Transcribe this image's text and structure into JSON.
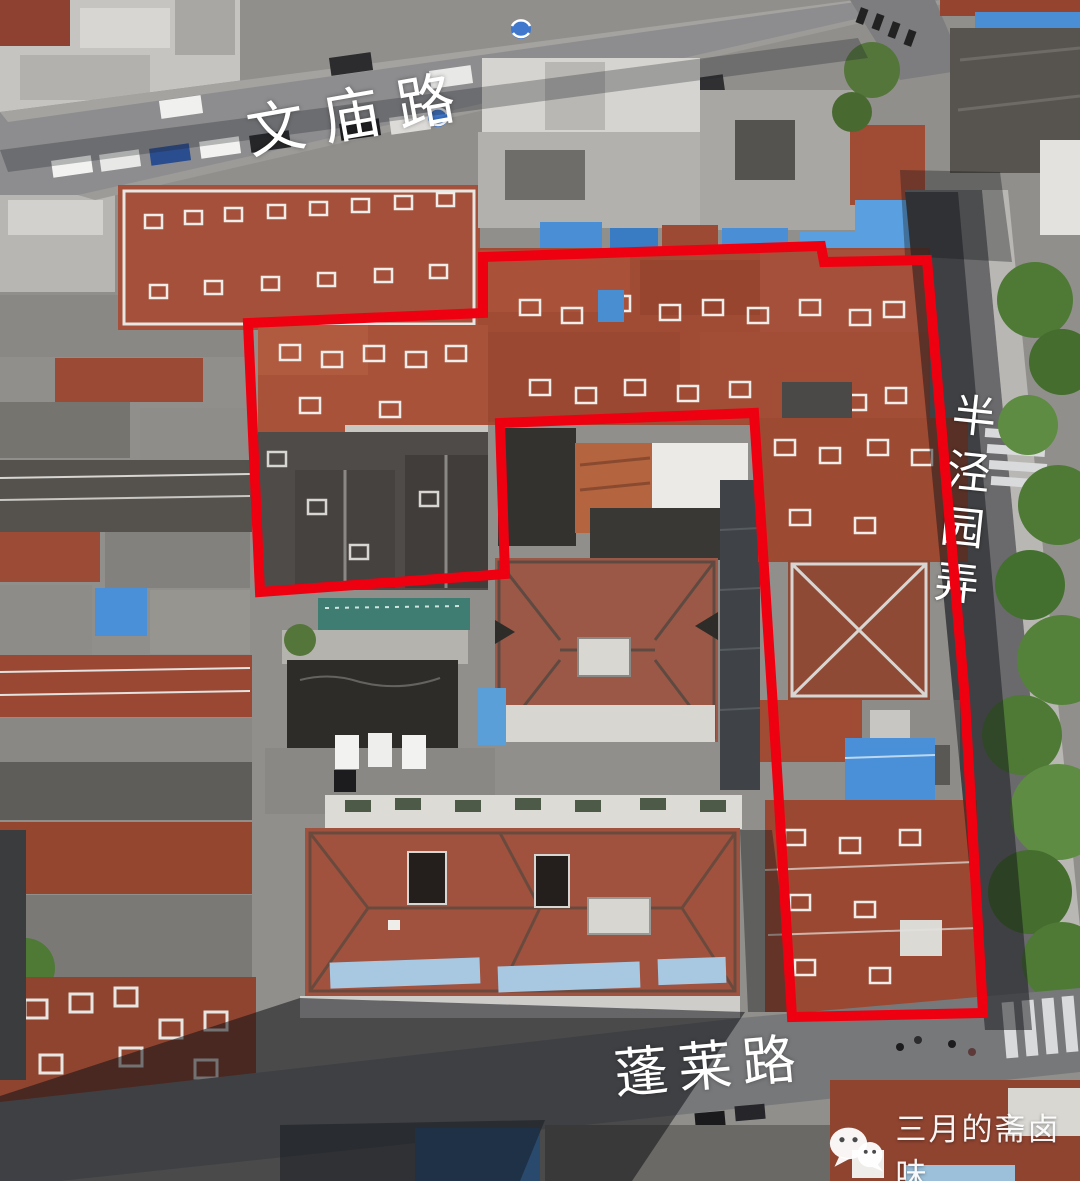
{
  "labels": {
    "top_road": "文庙路",
    "bottom_road": "蓬莱路",
    "right_lane": "半泾园弄"
  },
  "watermark": {
    "text": "三月的斋卤味",
    "icon": "wechat-icon"
  },
  "annotation": {
    "color": "#ee0011",
    "stroke_width": "10",
    "polygon_points": "483,257 821,246 824,262 927,260 965,700 983,1013 792,1017 777,770 754,413 500,423 505,574 260,592 248,323 483,313"
  },
  "palette": {
    "roof_red": "#a04b34",
    "roof_red_dark": "#8f4430",
    "roof_salmon": "#a0523f",
    "roof_slate": "#4e4b48",
    "roof_white": "#e8e6e2",
    "tarp_blue": "#4a8fd6",
    "road_gray": "#8d8d8f",
    "shadow_dark": "#14161a",
    "tree_green": "#4e7a36"
  }
}
